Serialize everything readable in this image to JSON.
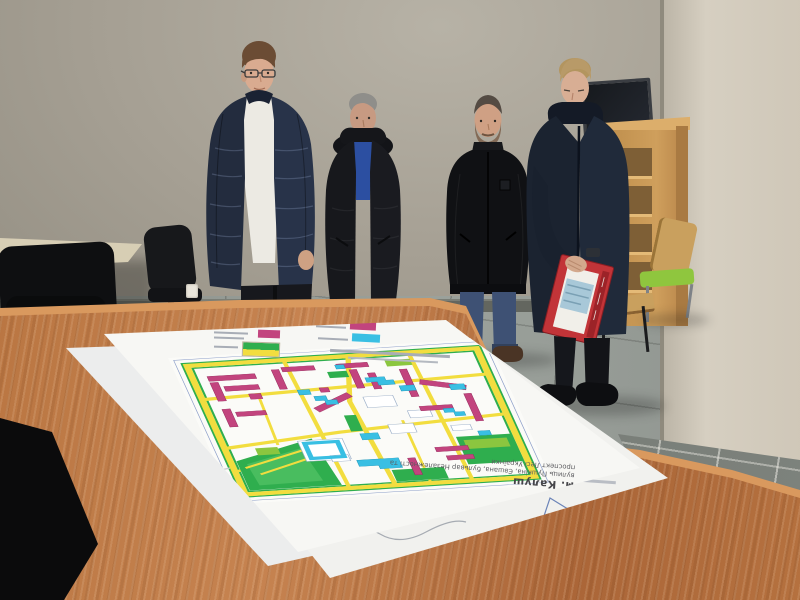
{
  "map_document": {
    "city_caption": "м. Калуш",
    "subtitle_caption": "вулиць Пушкіна, Євшана, бульвар Незалежності та проспект Лесі Українки",
    "legend_colors": {
      "planned_residential": "#c2447e",
      "planned_public": "#39bfe3",
      "greenery": "#2fae4e",
      "roads": "#f2dd3f"
    }
  },
  "palette": {
    "wall": "#a9a499",
    "wall_column": "#d6cfc1",
    "floor_tile": "#8f948f",
    "wainscot_tile": "#6e736e",
    "table_wood": "#b5713f",
    "paper": "#f7f7f4",
    "shelf_wood": "#c9995a",
    "green_chair_seat": "#8fc63e",
    "navy_jacket": "#232c3e",
    "black_jacket": "#101114",
    "parka": "#1b2330",
    "blue_sweater": "#2c4fa1",
    "jeans": "#4c6591",
    "red_booklet": "#c23438"
  }
}
